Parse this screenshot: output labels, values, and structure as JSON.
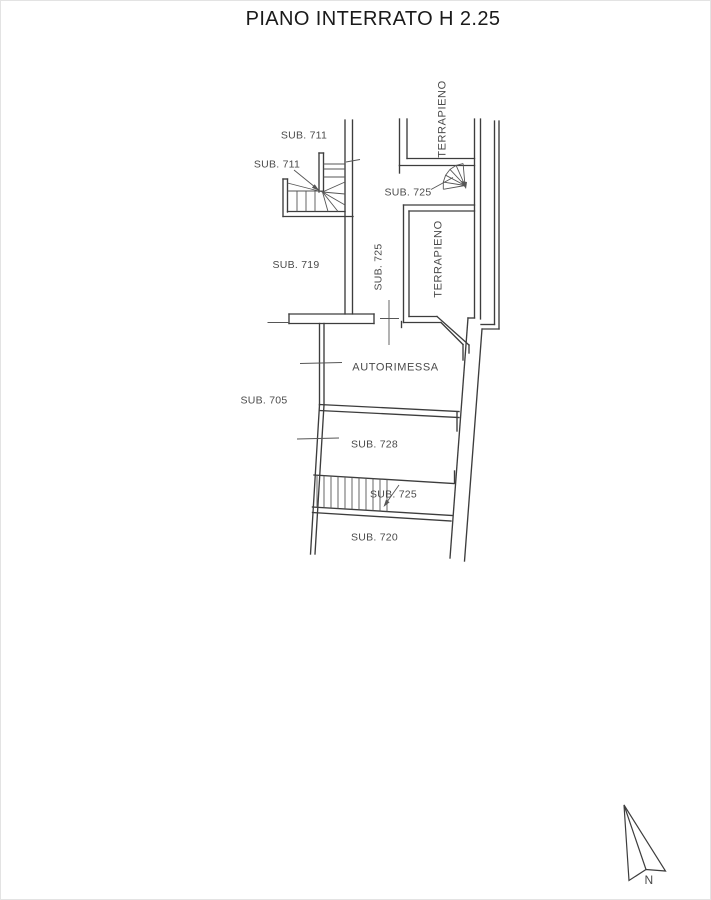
{
  "title": "PIANO INTERRATO H 2.25",
  "plan": {
    "labels": {
      "sub711_upper": "SUB. 711",
      "sub711_lower": "SUB. 711",
      "sub719": "SUB. 719",
      "sub725_shaft": "SUB. 725",
      "terrapieno_upper": "TERRAPIENO",
      "sub725_spiral": "SUB. 725",
      "terrapieno_lower": "TERRAPIENO",
      "autorimessa": "AUTORIMESSA",
      "sub705": "SUB. 705",
      "sub728": "SUB. 728",
      "sub725_stairs": "SUB. 725",
      "sub720": "SUB. 720"
    },
    "compass": {
      "north_label": "N"
    },
    "colors": {
      "line": "#3d3d3d",
      "detail": "#565656",
      "text": "#4a4a4a",
      "title": "#1a1a1a",
      "background": "#ffffff"
    }
  }
}
